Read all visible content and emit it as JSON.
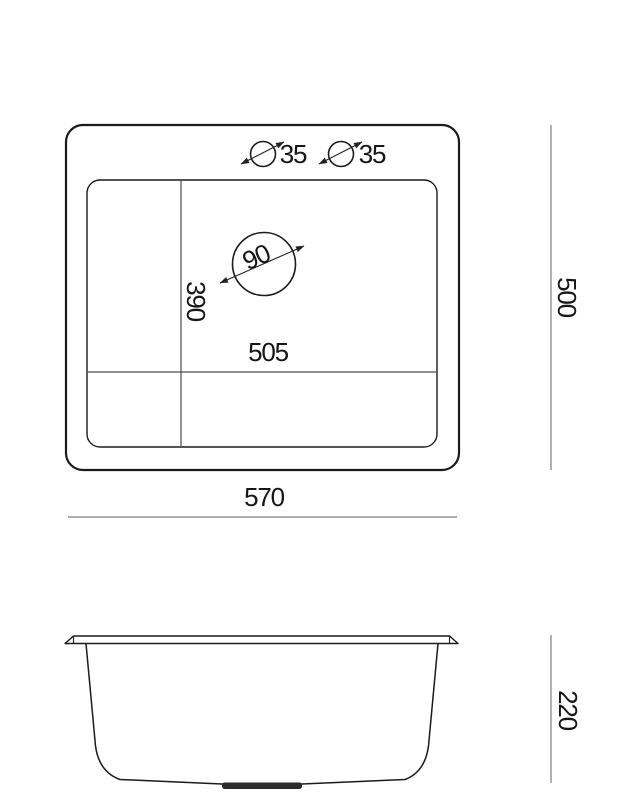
{
  "drawing": {
    "kind": "sink dimension drawing",
    "background": "#ffffff"
  },
  "top_view": {
    "tap_holes": [
      {
        "diameter": "35"
      },
      {
        "diameter": "35"
      }
    ],
    "drain": {
      "diameter": "90"
    },
    "bowl": {
      "width": "505",
      "depth": "390"
    },
    "overall": {
      "width": "570",
      "depth": "500"
    }
  },
  "side_view": {
    "height": "220"
  },
  "colors": {
    "outline": "#1b1b1b",
    "divider": "#4a4a4a",
    "dimension_line": "#7d7d7d",
    "drain_fill": "#2b2b2b",
    "text": "#161616"
  }
}
